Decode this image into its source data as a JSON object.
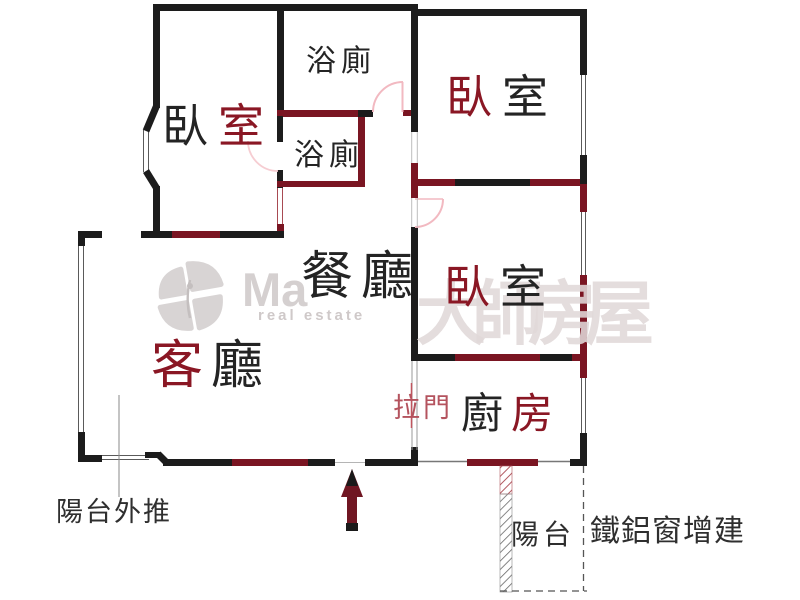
{
  "watermark": {
    "brand_partial": "Ma",
    "brand_tagline": "real estate",
    "brand_cjk": "大師房屋"
  },
  "rooms": {
    "bedroom_top_left": {
      "chars": [
        "臥",
        "室"
      ]
    },
    "bathroom_top": {
      "chars": [
        "浴",
        "廁"
      ]
    },
    "bathroom_ensuite": {
      "chars": [
        "浴",
        "廁"
      ]
    },
    "bedroom_top_right": {
      "chars": [
        "臥",
        "室"
      ]
    },
    "bedroom_mid_right": {
      "chars": [
        "臥",
        "室"
      ]
    },
    "dining_room": {
      "chars": [
        "餐",
        "廳"
      ]
    },
    "living_room": {
      "chars": [
        "客",
        "廳"
      ]
    },
    "kitchen": {
      "chars": [
        "廚",
        "房"
      ]
    },
    "balcony": {
      "label": "陽台"
    }
  },
  "annotations": {
    "sliding_door": "拉門",
    "balcony_pushed_out": "陽台外推",
    "metal_window_addition": "鐵鋁窗增建"
  },
  "colors": {
    "wall_black": "#1c1c1c",
    "wall_maroon": "#7a1522",
    "label_ink": "#242424",
    "label_maroon": "#8a1724",
    "sliding_door_red": "#b4535e",
    "door_arc_pink": "#f2b9c1",
    "arrow_maroon": "#701622",
    "watermark_gray": "#d8d4d4"
  }
}
